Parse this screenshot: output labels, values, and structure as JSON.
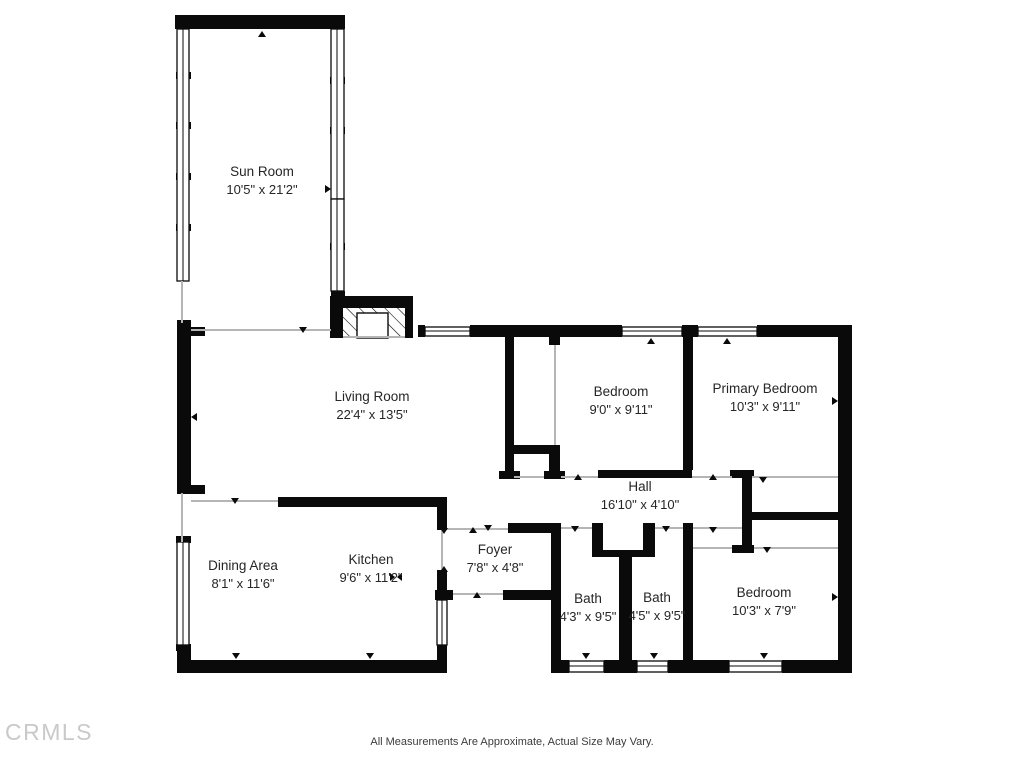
{
  "plan": {
    "rooms": [
      {
        "name": "Sun Room",
        "dims": "10'5\" x 21'2\""
      },
      {
        "name": "Living Room",
        "dims": "22'4\" x 13'5\""
      },
      {
        "name": "Bedroom",
        "dims": "9'0\" x 9'11\""
      },
      {
        "name": "Primary Bedroom",
        "dims": "10'3\" x 9'11\""
      },
      {
        "name": "Hall",
        "dims": "16'10\" x 4'10\""
      },
      {
        "name": "Dining Area",
        "dims": "8'1\" x 11'6\""
      },
      {
        "name": "Kitchen",
        "dims": "9'6\" x 11'2\""
      },
      {
        "name": "Foyer",
        "dims": "7'8\" x 4'8\""
      },
      {
        "name": "Bath",
        "dims": "4'3\" x 9'5\""
      },
      {
        "name": "Bath",
        "dims": "4'5\" x 9'5\""
      },
      {
        "name": "Bedroom",
        "dims": "10'3\" x 7'9\""
      }
    ],
    "footer": "All Measurements Are Approximate, Actual Size May Vary.",
    "watermark": "CRMLS",
    "colors": {
      "wall": "#0a0a0a",
      "background": "#ffffff",
      "opening_line": "#b5b5b5",
      "label_text": "#262626",
      "watermark": "#c9c9c9"
    }
  }
}
